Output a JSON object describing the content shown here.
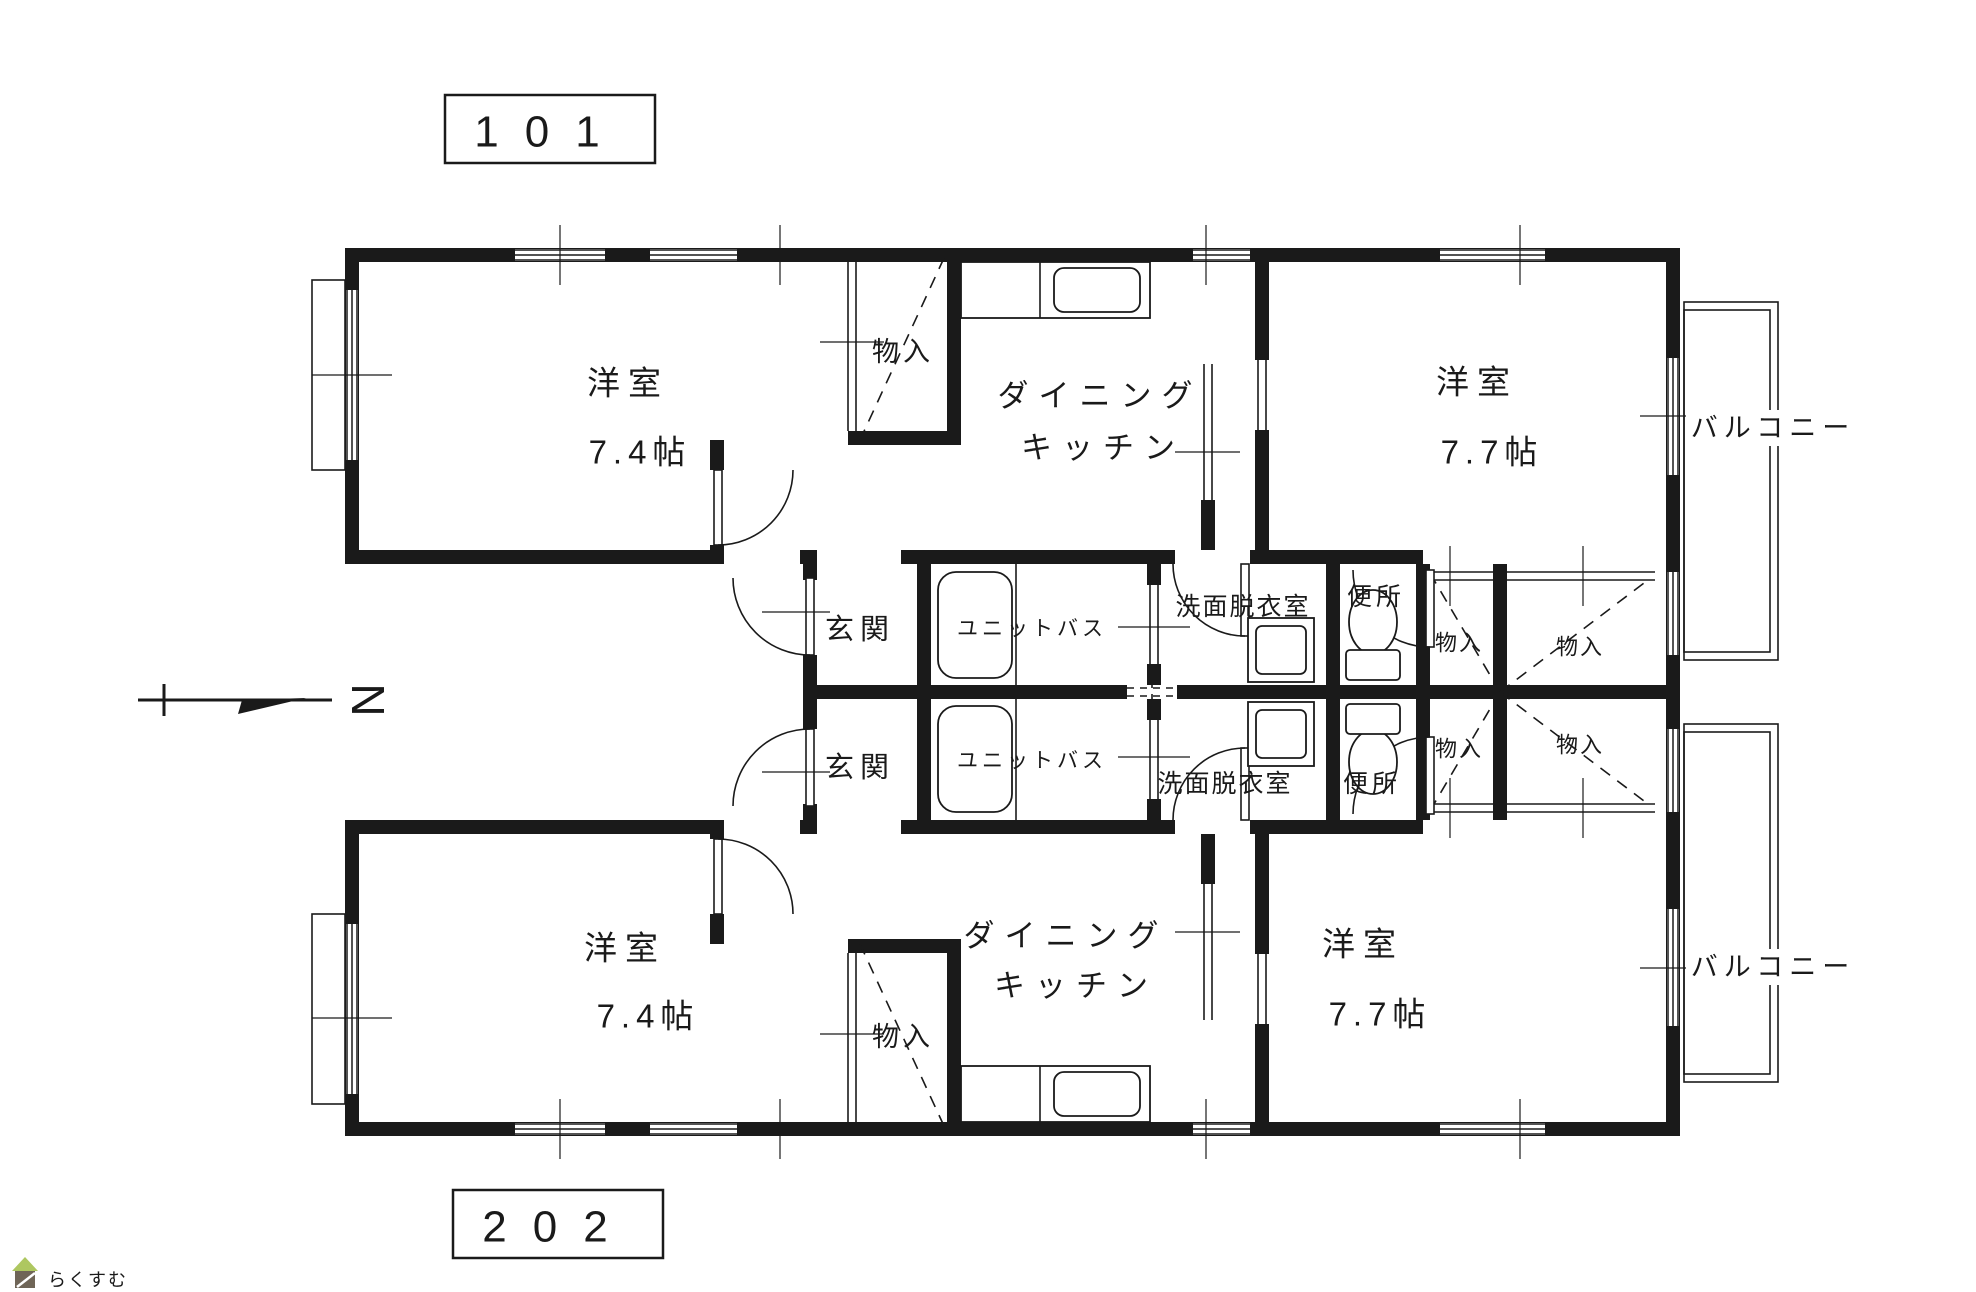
{
  "plan": {
    "unit_labels": {
      "top": "101",
      "bottom": "202"
    },
    "compass": {
      "north_label": "N"
    },
    "watermark": {
      "brand": "らくすむ"
    },
    "colors": {
      "line": "#1a1a1a",
      "background": "#ffffff",
      "watermark_roof": "#aec760",
      "watermark_body": "#6f6557",
      "watermark_text": "#a59c95"
    },
    "unit101": {
      "western_room_left": {
        "name": "洋室",
        "size": "7.4帖"
      },
      "closet_top": "物入",
      "dining": "ダイニング",
      "kitchen": "キッチン",
      "western_room_right": {
        "name": "洋室",
        "size": "7.7帖"
      },
      "balcony": "バルコニー",
      "entrance": "玄関",
      "unit_bath": "ユニットバス",
      "washroom": "洗面脱衣室",
      "toilet": "便所",
      "closet_hall_1": "物入",
      "closet_hall_2": "物入"
    },
    "unit202": {
      "western_room_left": {
        "name": "洋室",
        "size": "7.4帖"
      },
      "closet_top": "物入",
      "dining": "ダイニング",
      "kitchen": "キッチン",
      "western_room_right": {
        "name": "洋室",
        "size": "7.7帖"
      },
      "balcony": "バルコニー",
      "entrance": "玄関",
      "unit_bath": "ユニットバス",
      "washroom": "洗面脱衣室",
      "toilet": "便所",
      "closet_hall_1": "物入",
      "closet_hall_2": "物入"
    }
  }
}
